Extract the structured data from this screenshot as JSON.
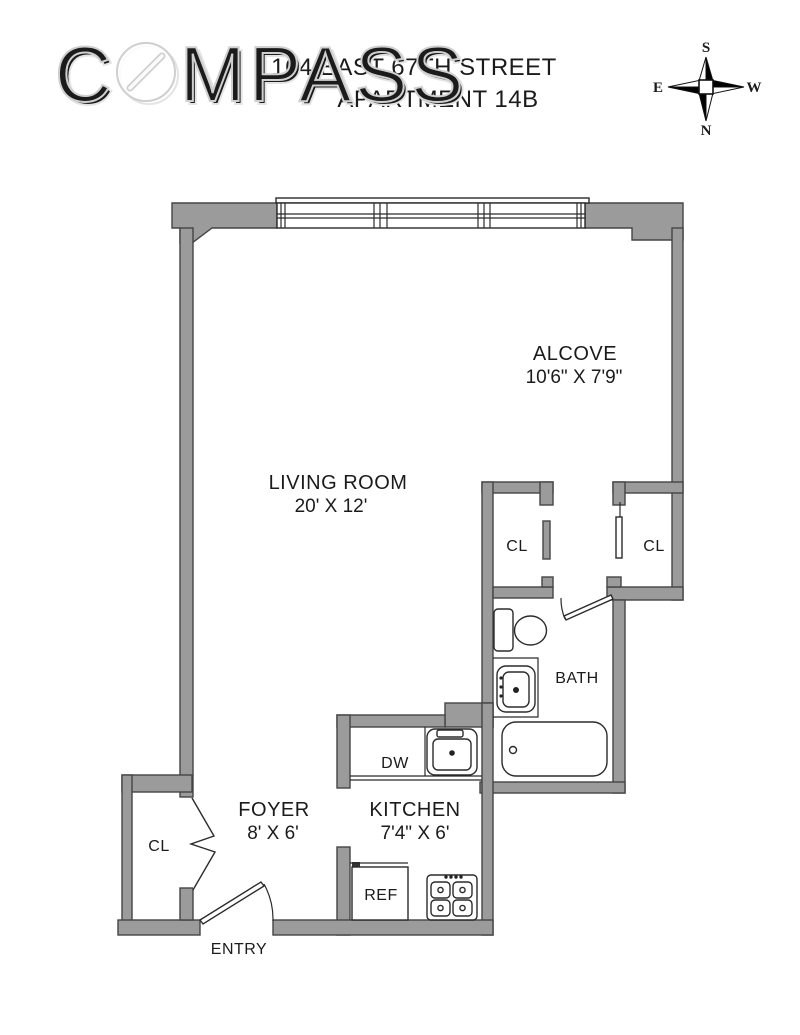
{
  "title": {
    "line1": "164 EAST 67TH STREET",
    "line2": "APARTMENT 14B"
  },
  "watermark": {
    "brand": "COMPASS",
    "letters_before_o": "C",
    "letters_after_o": "MPASS"
  },
  "compass_rose": {
    "top": "S",
    "bottom": "N",
    "left": "E",
    "right": "W"
  },
  "rooms": {
    "living": {
      "name": "LIVING ROOM",
      "dims": "20' X 12'"
    },
    "alcove": {
      "name": "ALCOVE",
      "dims": "10'6\" X 7'9\""
    },
    "foyer": {
      "name": "FOYER",
      "dims": "8' X 6'"
    },
    "kitchen": {
      "name": "KITCHEN",
      "dims": "7'4\" X 6'"
    },
    "bath": {
      "name": "BATH"
    },
    "entry": {
      "name": "ENTRY"
    },
    "closet": {
      "abbr": "CL"
    }
  },
  "appliances": {
    "dishwasher": "DW",
    "refrigerator": "REF"
  },
  "colors": {
    "wall_fill": "#9b9b9b",
    "wall_stroke": "#454545",
    "fixture_stroke": "#2b2b2b",
    "text": "#1b1b1b",
    "watermark_stroke": "#cfcfcf"
  }
}
